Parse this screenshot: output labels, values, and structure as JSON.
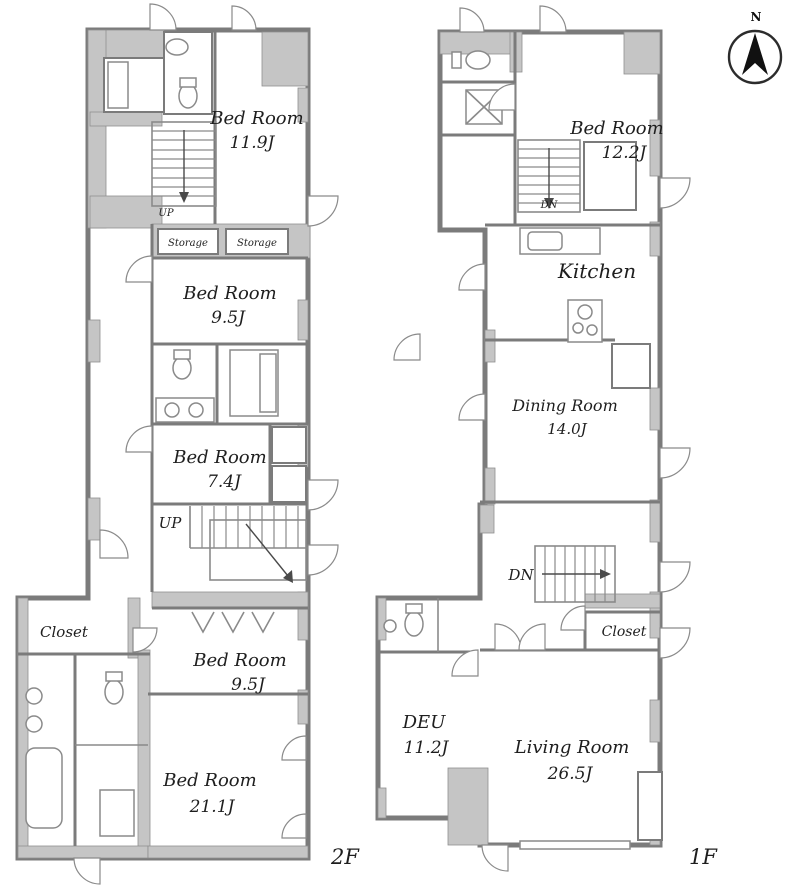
{
  "compass": {
    "label": "N"
  },
  "colors": {
    "wall": "#7b7b7b",
    "poche": "#c5c5c5",
    "room_fill": "#ffffff",
    "text": "#1e1e1e"
  },
  "floor_2f": {
    "label": "2F",
    "rooms": {
      "bedroom_a": {
        "name": "Bed Room",
        "size": "11.9J"
      },
      "storage_left": {
        "name": "Storage"
      },
      "storage_right": {
        "name": "Storage"
      },
      "bedroom_b": {
        "name": "Bed Room",
        "size": "9.5J"
      },
      "bedroom_c": {
        "name": "Bed Room",
        "size": "7.4J"
      },
      "stairs_top": {
        "name": "UP"
      },
      "stairs_mid": {
        "name": "UP"
      },
      "bedroom_d": {
        "name": "Bed Room",
        "size": "9.5J"
      },
      "closet": {
        "name": "Closet"
      },
      "bedroom_e": {
        "name": "Bed Room",
        "size": "21.1J"
      }
    }
  },
  "floor_1f": {
    "label": "1F",
    "rooms": {
      "bedroom": {
        "name": "Bed Room",
        "size": "12.2J"
      },
      "stairs_top": {
        "name": "DN"
      },
      "kitchen": {
        "name": "Kitchen"
      },
      "dining": {
        "name": "Dining Room",
        "size": "14.0J"
      },
      "stairs_mid": {
        "name": "DN"
      },
      "closet": {
        "name": "Closet"
      },
      "deu": {
        "name": "DEU",
        "size": "11.2J"
      },
      "living": {
        "name": "Living Room",
        "size": "26.5J"
      }
    }
  }
}
